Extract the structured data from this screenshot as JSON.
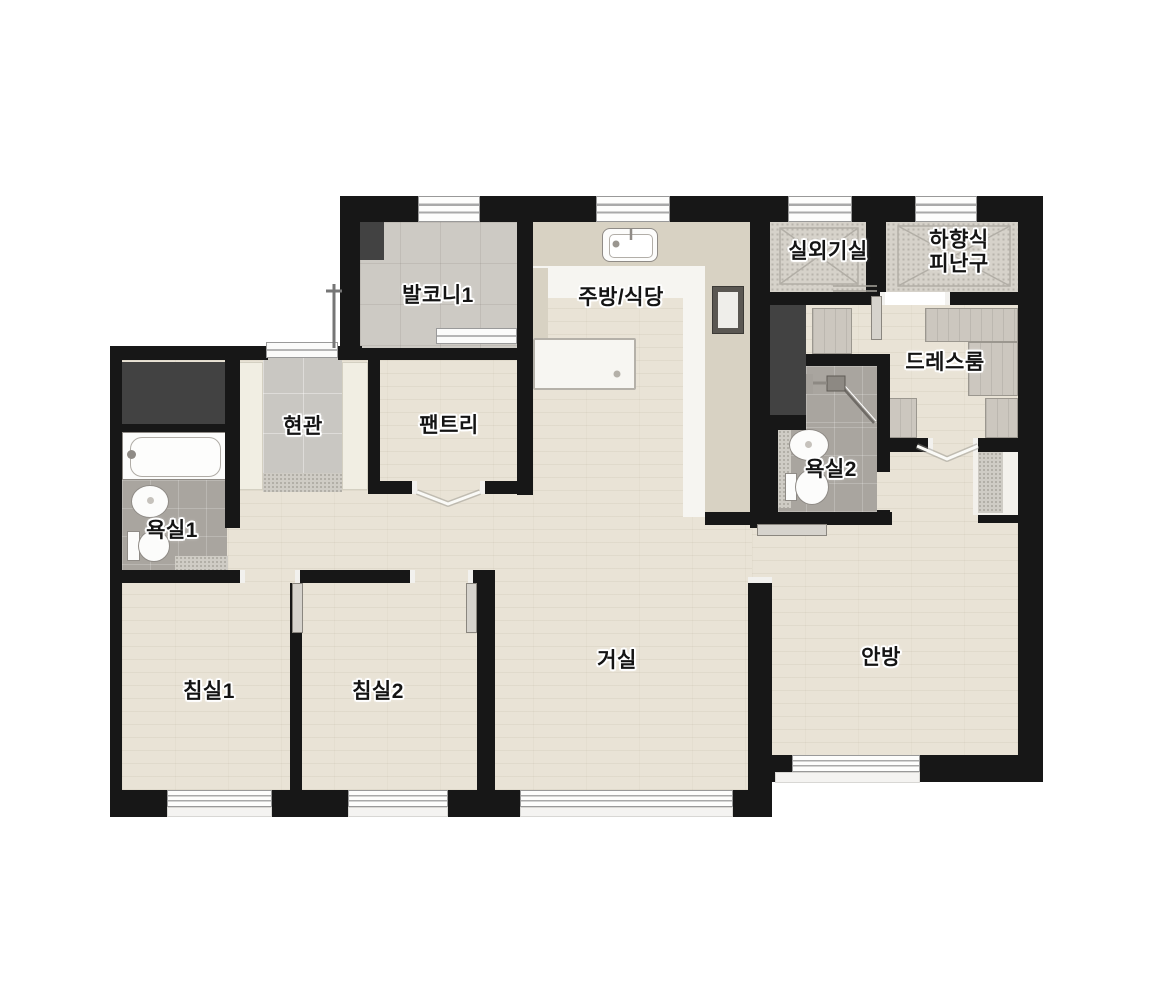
{
  "plan": {
    "type": "apartment-floor-plan",
    "rooms": {
      "balcony1": "발코니1",
      "kitchen_dining": "주방/식당",
      "outdoor_unit": "실외기실",
      "escape_hatch": "하향식\n피난구",
      "dressroom": "드레스룸",
      "entrance": "현관",
      "pantry": "팬트리",
      "bathroom1": "욕실1",
      "bathroom2": "욕실2",
      "living": "거실",
      "master": "안방",
      "bedroom1": "침실1",
      "bedroom2": "침실2"
    },
    "fixtures": [
      "bathtub",
      "toilet",
      "wash-basin",
      "shower",
      "kitchen-sink",
      "island-counter",
      "built-in-oven",
      "wardrobe-cabinets",
      "escape-hatch-x",
      "ac-duct-shaft",
      "sliding-window",
      "door-swing"
    ],
    "colors": {
      "wall": "#171717",
      "wood_floor": "#e9e3d6",
      "bath_tile": "#a9a59f",
      "entry_tile": "#c9c7c2",
      "balcony_tile": "#cdcac4",
      "utility_floor": "#d6d2ca",
      "counter": "#d8d2c3",
      "cabinet": "#ccc7bf",
      "shaft": "#424242",
      "window_frame": "#9a9a9a",
      "background": "#ffffff"
    }
  }
}
